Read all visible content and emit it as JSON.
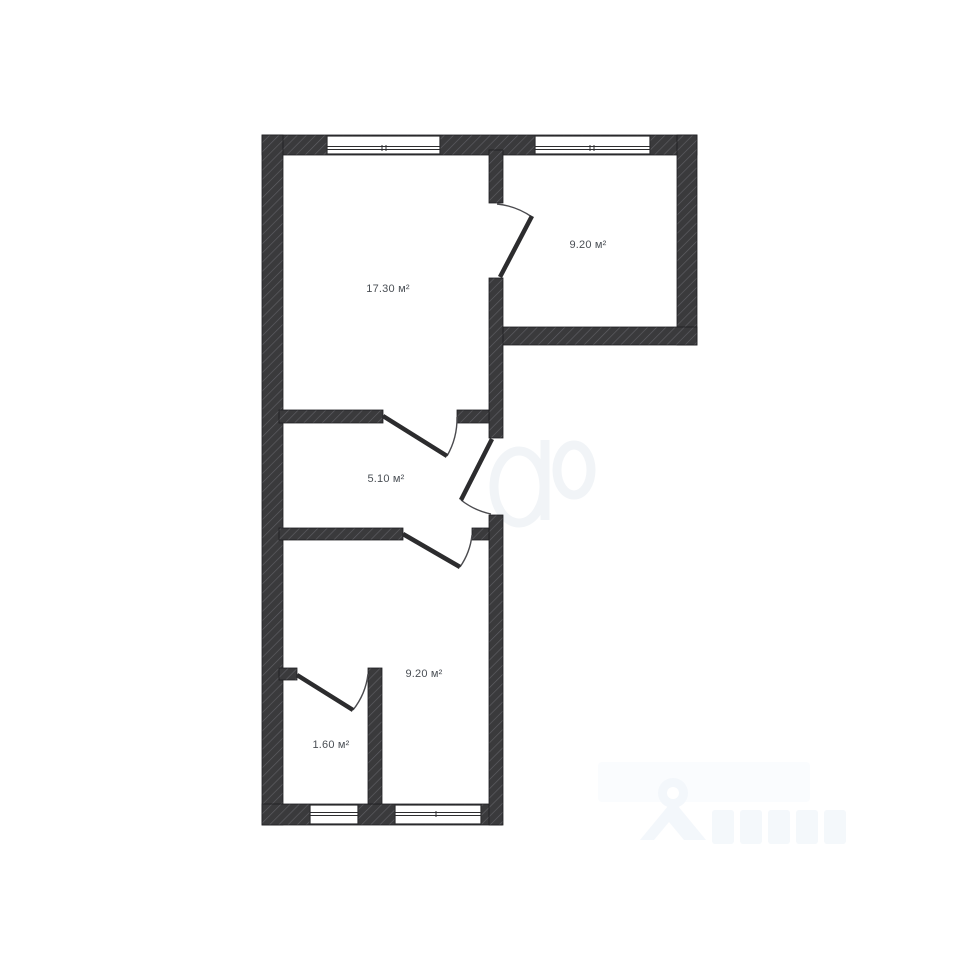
{
  "document": {
    "type": "apartment-floor-plan"
  },
  "rooms": [
    {
      "id": "living-room",
      "area_label": "17.30 м²"
    },
    {
      "id": "room-top-right",
      "area_label": "9.20 м²"
    },
    {
      "id": "hallway",
      "area_label": "5.10 м²"
    },
    {
      "id": "room-bottom",
      "area_label": "9.20 м²"
    },
    {
      "id": "storage",
      "area_label": "1.60 м²"
    }
  ],
  "counts": {
    "windows": 4,
    "door_openings": 5
  },
  "colors": {
    "background": "#ffffff",
    "wall_fill": "#3a3a3c",
    "wall_hatch": "#5f5f64",
    "wall_outline": "#1f1f21",
    "window_frame": "#2d2d2f",
    "door_leaf": "#2c2c2e",
    "door_arc": "#4b4b4f",
    "label_text": "#4a4f55",
    "watermark_tint": "#f3f7fb"
  }
}
